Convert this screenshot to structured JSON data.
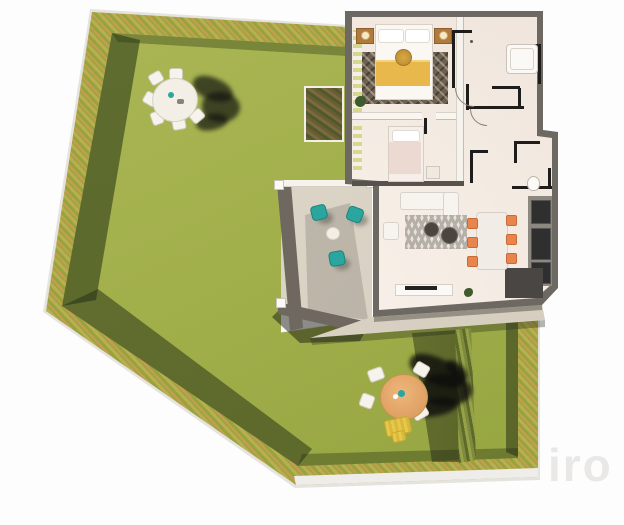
{
  "watermark_text": "iro",
  "palette": {
    "lawn": "#a2b04c",
    "lawn_dark": "#93a33e",
    "hedge": "#b4aa50",
    "hedge_accent": "#c69d55",
    "hedge_shadow": "#35431f",
    "house_floor": "#f3eae2",
    "outer_wall": "#6e6862",
    "partition_wall": "#1f1d1b",
    "terrace_floor": "#dcd5c7",
    "walkway": "#d9d2c4",
    "teal_chair": "#2ba69e",
    "dining_chair_orange": "#e8854e",
    "bed_blanket_yellow": "#e9b84d",
    "parasol_tan": "#e2a366",
    "lounger_yellow": "#e3c246",
    "cast_shadow": "#17181a",
    "watermark_gray": "#c3beb8"
  },
  "scene": {
    "description": "3D top-down architectural rendering of a ground-floor apartment with private garden",
    "rooms": [
      "master-bedroom",
      "second-bedroom",
      "hallway",
      "bathroom",
      "wc",
      "kitchen",
      "living-dining-room"
    ],
    "outdoor": [
      "lawn",
      "hedge-boundary",
      "terrace",
      "walkway",
      "hedge-divider",
      "garden-dining-set-north",
      "parasol-set-south",
      "sun-lounger",
      "planter-box"
    ]
  }
}
